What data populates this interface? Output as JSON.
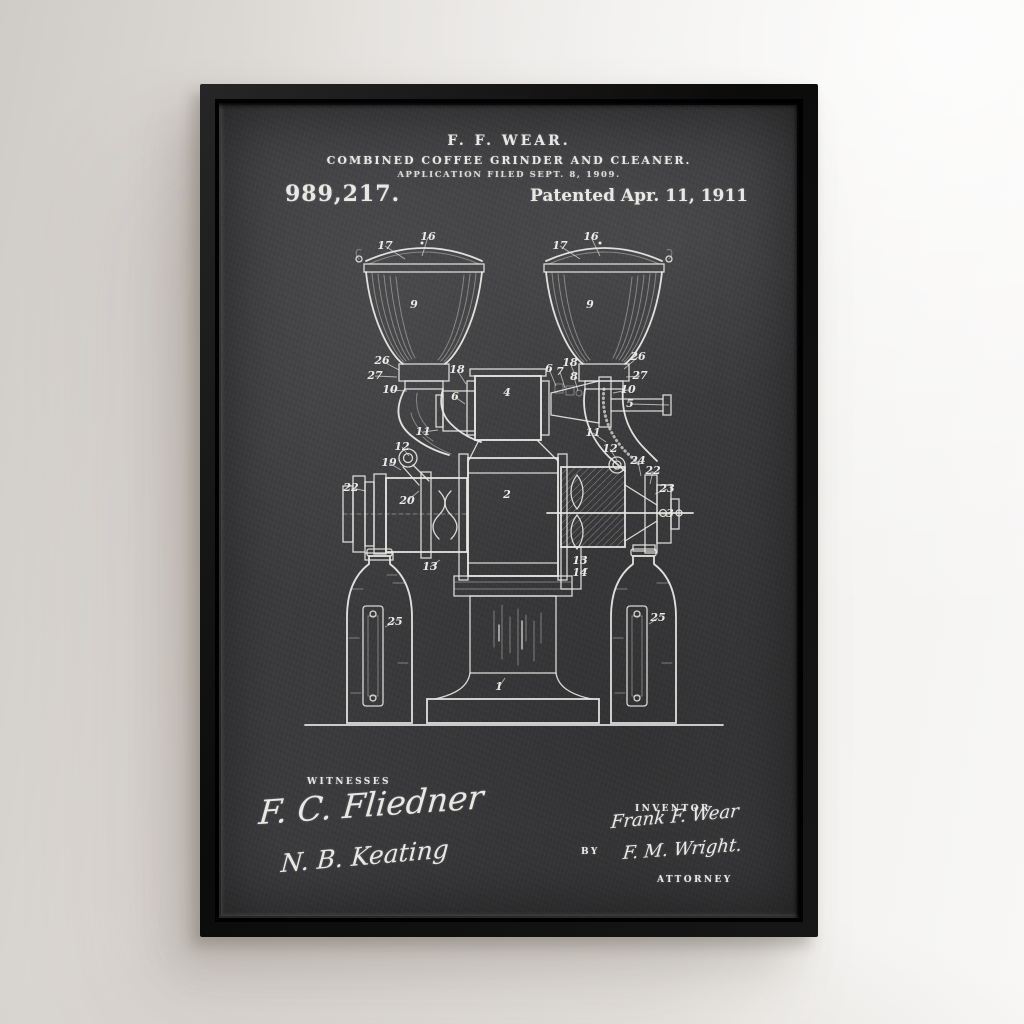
{
  "poster": {
    "header": {
      "inventor_line": "F. F. WEAR.",
      "title_line": "COMBINED COFFEE GRINDER AND CLEANER.",
      "application_line": "APPLICATION FILED SEPT. 8, 1909.",
      "patent_number": "989,217.",
      "patent_date": "Patented Apr. 11, 1911"
    },
    "signatures": {
      "witnesses_label": "WITNESSES",
      "witness_1": "F. C. Fliedner",
      "witness_2": "N. B. Keating",
      "inventor_label": "INVENTOR",
      "inventor_signature": "Frank F. Wear",
      "by_label": "BY",
      "attorney_signature": "F. M. Wright.",
      "attorney_label": "ATTORNEY"
    },
    "colors": {
      "wall": "#eae7e4",
      "frame": "#121212",
      "poster": "#3f3f41",
      "chalk": "#e8e8e5"
    },
    "drawing": {
      "description": "Front elevation of combined coffee grinder and cleaner: two ribbed hoppers feeding a central grinder on a pedestal, with side cleaner drums and two collecting jars",
      "ref_labels": [
        {
          "t": "17",
          "x": 96,
          "y": 26,
          "lx": 116,
          "ly": 36
        },
        {
          "t": "16",
          "x": 139,
          "y": 17,
          "lx": 133,
          "ly": 33
        },
        {
          "t": "9",
          "x": 125,
          "y": 85,
          "lx": null,
          "ly": null
        },
        {
          "t": "26",
          "x": 93,
          "y": 141,
          "lx": 110,
          "ly": 147
        },
        {
          "t": "27",
          "x": 86,
          "y": 156,
          "lx": 108,
          "ly": 154
        },
        {
          "t": "10",
          "x": 101,
          "y": 170,
          "lx": 118,
          "ly": 168
        },
        {
          "t": "17",
          "x": 271,
          "y": 26,
          "lx": 291,
          "ly": 36
        },
        {
          "t": "16",
          "x": 302,
          "y": 17,
          "lx": 311,
          "ly": 33
        },
        {
          "t": "9",
          "x": 301,
          "y": 85,
          "lx": null,
          "ly": null
        },
        {
          "t": "26",
          "x": 349,
          "y": 137,
          "lx": 335,
          "ly": 146
        },
        {
          "t": "27",
          "x": 351,
          "y": 156,
          "lx": 337,
          "ly": 154
        },
        {
          "t": "10",
          "x": 339,
          "y": 170,
          "lx": 324,
          "ly": 170
        },
        {
          "t": "5",
          "x": 341,
          "y": 184,
          "lx": 380,
          "ly": 182
        },
        {
          "t": "18",
          "x": 168,
          "y": 150,
          "lx": 177,
          "ly": 161
        },
        {
          "t": "6",
          "x": 166,
          "y": 177,
          "lx": 176,
          "ly": 181
        },
        {
          "t": "4",
          "x": 218,
          "y": 173,
          "lx": null,
          "ly": null
        },
        {
          "t": "18",
          "x": 281,
          "y": 143,
          "lx": 288,
          "ly": 156
        },
        {
          "t": "6",
          "x": 260,
          "y": 149,
          "lx": 267,
          "ly": 163
        },
        {
          "t": "7",
          "x": 271,
          "y": 152,
          "lx": 276,
          "ly": 165
        },
        {
          "t": "8",
          "x": 285,
          "y": 157,
          "lx": 289,
          "ly": 168
        },
        {
          "t": "11",
          "x": 134,
          "y": 212,
          "lx": 149,
          "ly": 207
        },
        {
          "t": "11",
          "x": 304,
          "y": 213,
          "lx": 317,
          "ly": 219
        },
        {
          "t": "12",
          "x": 113,
          "y": 227,
          "lx": 120,
          "ly": 233
        },
        {
          "t": "12",
          "x": 321,
          "y": 229,
          "lx": 328,
          "ly": 237
        },
        {
          "t": "19",
          "x": 100,
          "y": 243,
          "lx": 112,
          "ly": 247
        },
        {
          "t": "20",
          "x": 118,
          "y": 281,
          "lx": 130,
          "ly": 268
        },
        {
          "t": "22",
          "x": 62,
          "y": 268,
          "lx": 77,
          "ly": 268
        },
        {
          "t": "2",
          "x": 218,
          "y": 275,
          "lx": null,
          "ly": null
        },
        {
          "t": "24",
          "x": 349,
          "y": 241,
          "lx": 352,
          "ly": 253
        },
        {
          "t": "22",
          "x": 364,
          "y": 251,
          "lx": 361,
          "ly": 261
        },
        {
          "t": "23",
          "x": 378,
          "y": 269,
          "lx": 366,
          "ly": 271
        },
        {
          "t": "3",
          "x": 381,
          "y": 294,
          "lx": 369,
          "ly": 291
        },
        {
          "t": "13",
          "x": 141,
          "y": 347,
          "lx": 151,
          "ly": 337
        },
        {
          "t": "13",
          "x": 291,
          "y": 341,
          "lx": 297,
          "ly": 333
        },
        {
          "t": "14",
          "x": 291,
          "y": 353,
          "lx": 299,
          "ly": 345
        },
        {
          "t": "25",
          "x": 106,
          "y": 402,
          "lx": 96,
          "ly": 404
        },
        {
          "t": "25",
          "x": 369,
          "y": 398,
          "lx": 360,
          "ly": 401
        },
        {
          "t": "1",
          "x": 210,
          "y": 467,
          "lx": 216,
          "ly": 455
        }
      ]
    }
  }
}
